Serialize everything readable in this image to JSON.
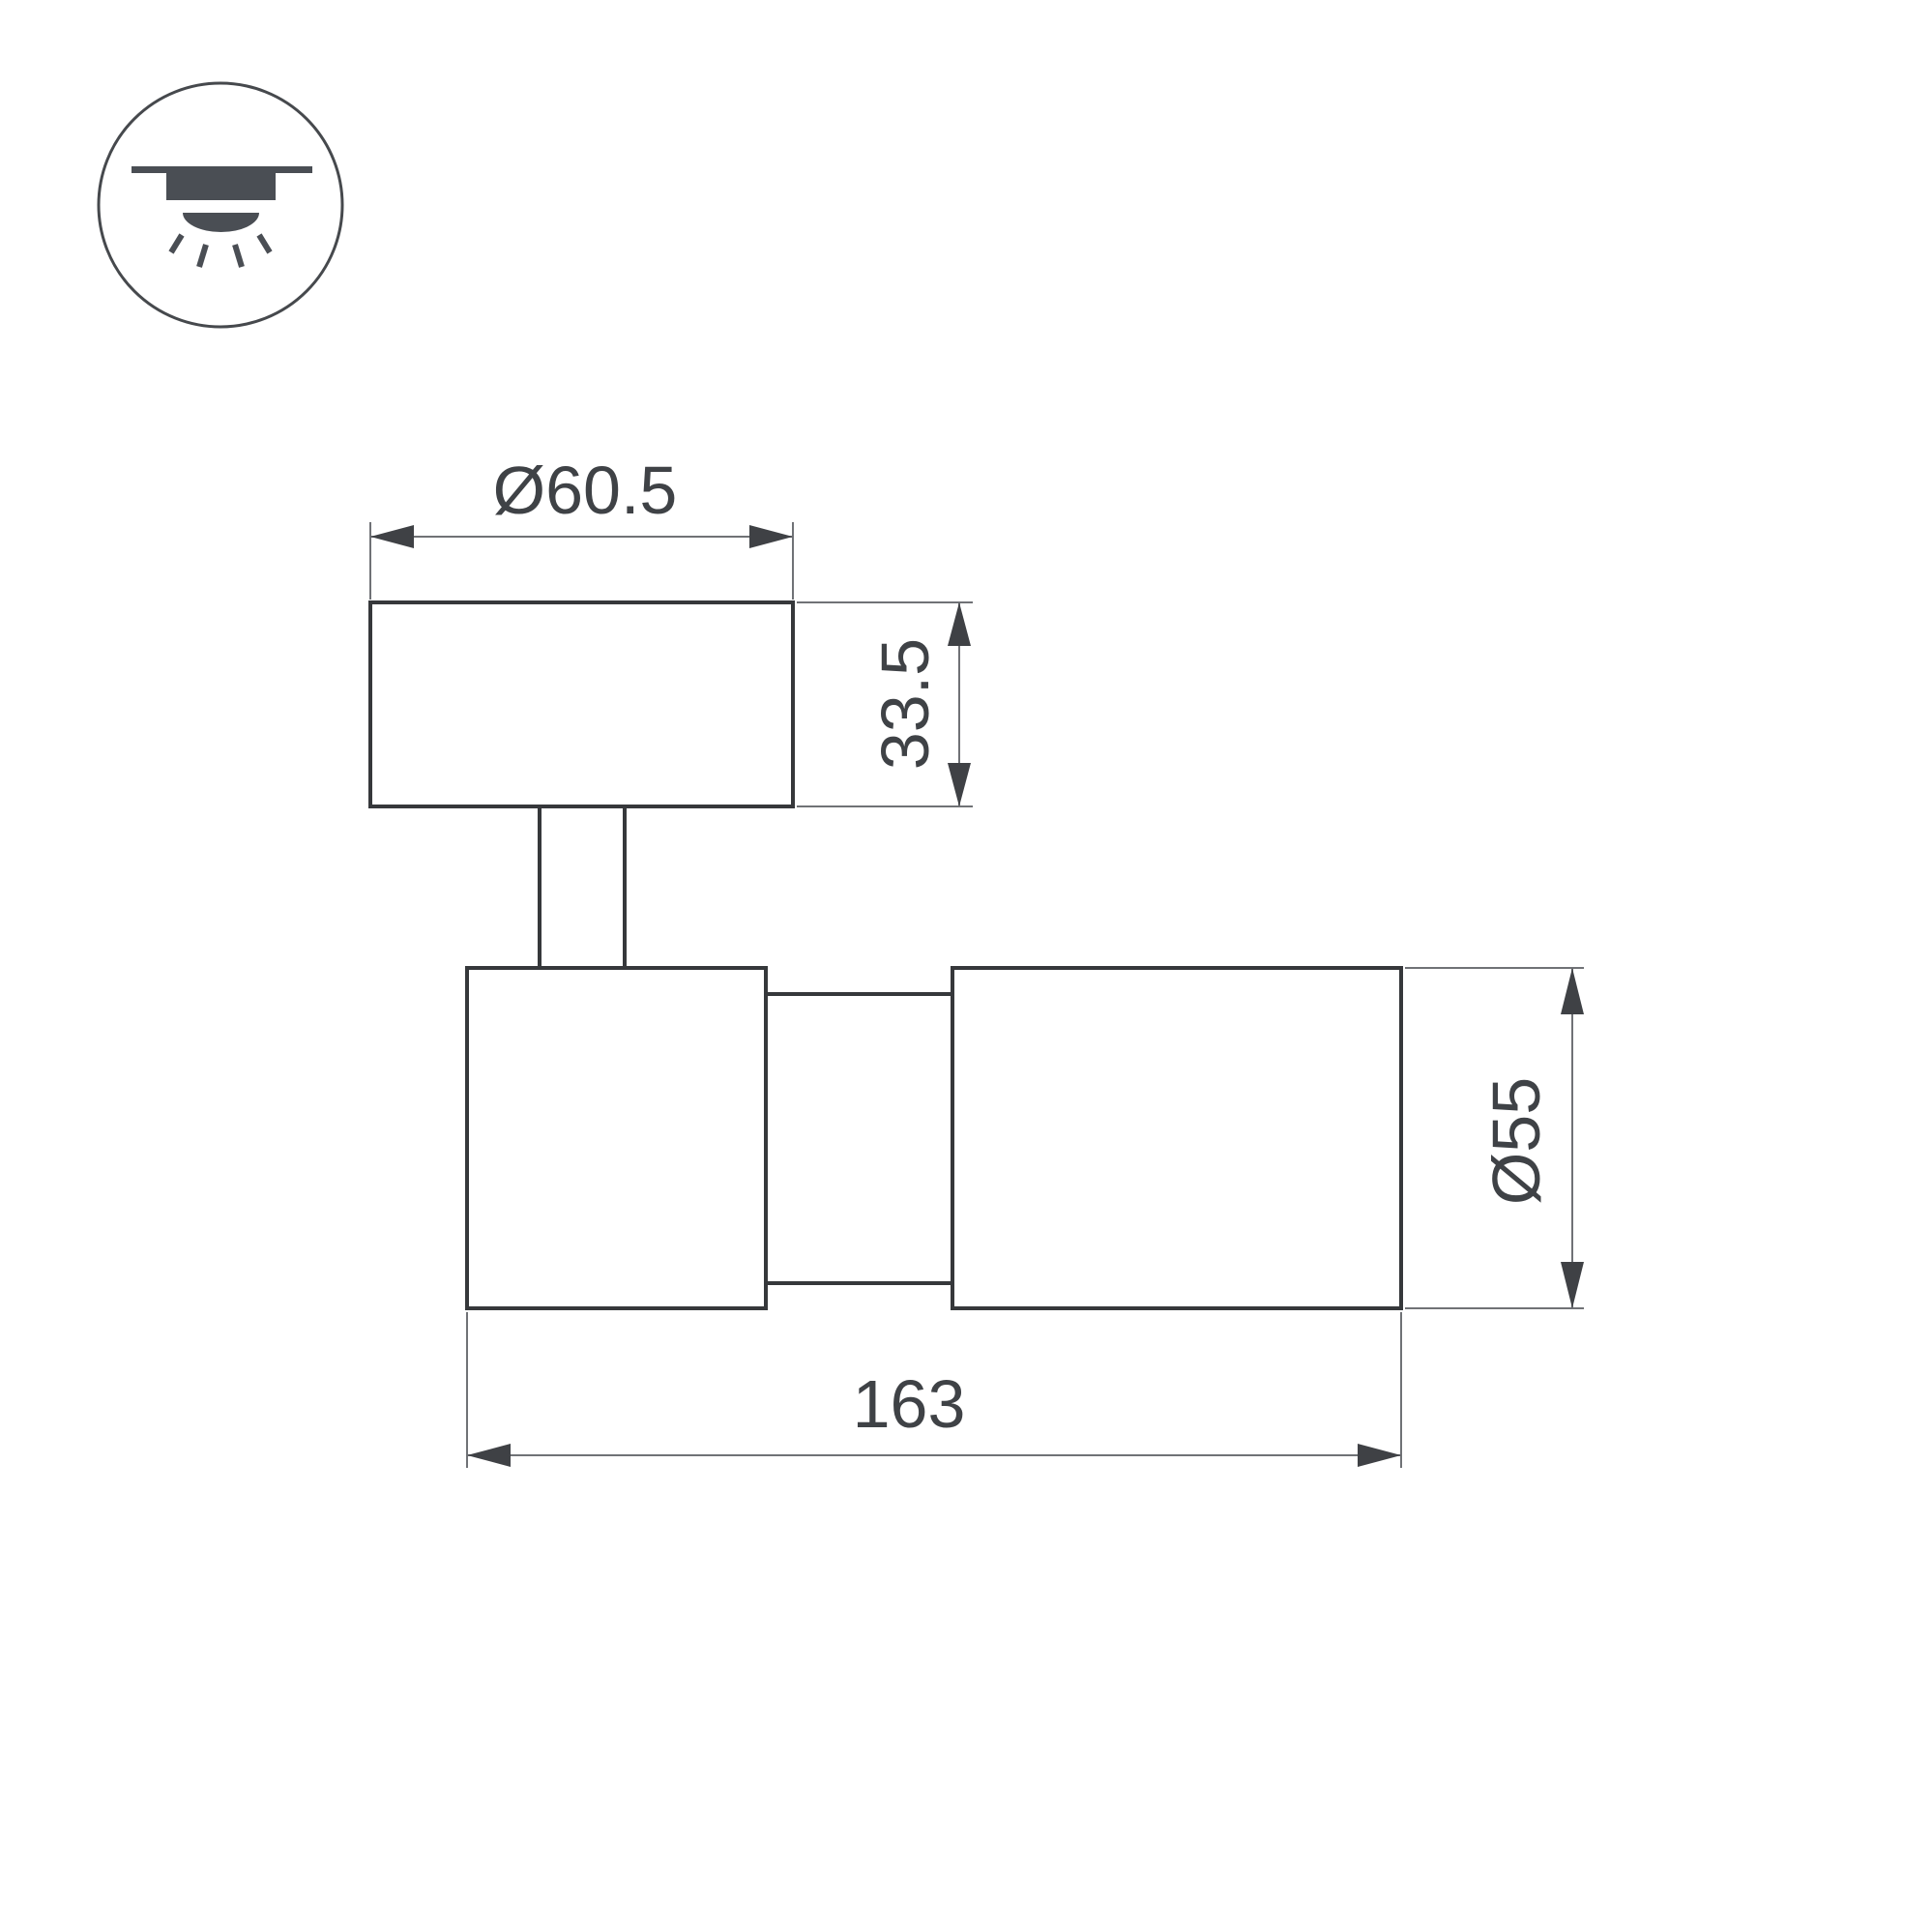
{
  "icon": {
    "name": "ceiling-mounted-light-icon",
    "symbol_color": "#4a4e54",
    "circle_stroke": "#46494d"
  },
  "drawing": {
    "background": "#ffffff",
    "outline_color": "#36383b",
    "dimension_line_color": "#707276",
    "arrow_color": "#3f4145",
    "text_color": "#3f4246"
  },
  "dimensions": {
    "head_diameter": "Ø60.5",
    "head_height": "33.5",
    "body_diameter": "Ø55",
    "overall_length": "163"
  }
}
